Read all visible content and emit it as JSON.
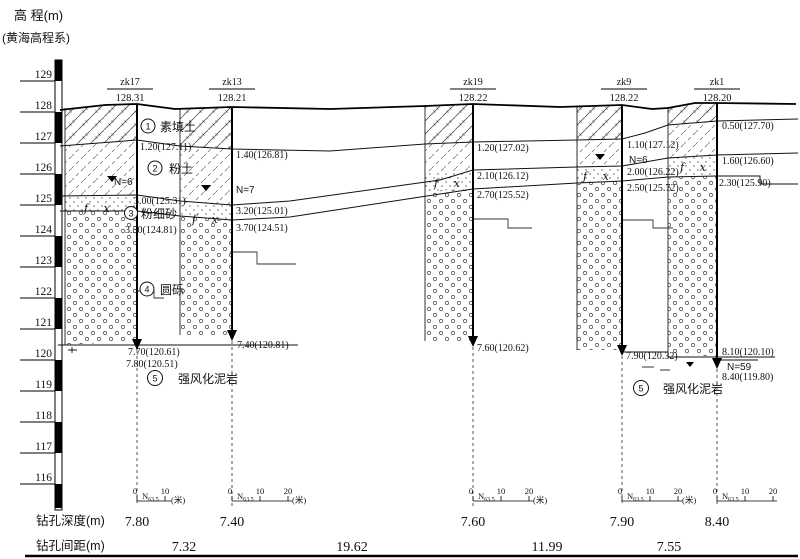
{
  "axis": {
    "title": "高 程(m)",
    "subtitle": "(黄海高程系)",
    "ticks": [
      "129",
      "128",
      "127",
      "126",
      "125",
      "124",
      "123",
      "122",
      "121",
      "120",
      "119",
      "118",
      "117",
      "116"
    ]
  },
  "boreholes": [
    {
      "name": "zk17",
      "elev": "128.31",
      "depth": "7.80",
      "labels": [
        "1.20(127.11)",
        "3.00(125.31)",
        "3.50(124.81)"
      ],
      "bottom_labels": [
        "7.70(120.61)",
        "7.80(120.51)"
      ],
      "n_label": "N=6"
    },
    {
      "name": "zk13",
      "elev": "128.21",
      "depth": "7.40",
      "labels": [
        "1.40(126.81)",
        "3.20(125.01)",
        "3.70(124.51)"
      ],
      "bottom_labels": [
        "7.40(120.81)"
      ],
      "n_label": "N=7"
    },
    {
      "name": "zk19",
      "elev": "128.22",
      "depth": "7.60",
      "labels": [
        "1.20(127.02)",
        "2.10(126.12)",
        "2.70(125.52)"
      ],
      "bottom_labels": [
        "7.60(120.62)"
      ]
    },
    {
      "name": "zk9",
      "elev": "128.22",
      "depth": "7.90",
      "labels": [
        "1.10(127.12)",
        "2.00(126.22)",
        "2.50(125.72)"
      ],
      "bottom_labels": [
        "7.90(120.32)"
      ],
      "n_label": "N=6"
    },
    {
      "name": "zk1",
      "elev": "128.20",
      "depth": "8.40",
      "labels": [
        "0.50(127.70)",
        "1.60(126.60)",
        "2.30(125.90)"
      ],
      "bottom_labels": [
        "8.10(120.10)",
        "8.40(119.80)"
      ],
      "n_label": "N=59"
    }
  ],
  "layers": [
    {
      "num": "1",
      "name": "素填土"
    },
    {
      "num": "2",
      "name": "粉土"
    },
    {
      "num": "3",
      "name": "粉细砂"
    },
    {
      "num": "4",
      "name": "圆砾"
    },
    {
      "num": "5",
      "name": "强风化泥岩"
    }
  ],
  "symbols": {
    "fx": "f x"
  },
  "scale_bar": {
    "n": "N",
    "sub": "63.5",
    "t0": "0",
    "t10": "10",
    "t20": "20",
    "unit": "(米)"
  },
  "footer": {
    "depth_label": "钻孔深度(m)",
    "spacing_label": "钻孔间距(m)",
    "spacings": [
      "7.32",
      "19.62",
      "11.99",
      "7.55"
    ]
  }
}
